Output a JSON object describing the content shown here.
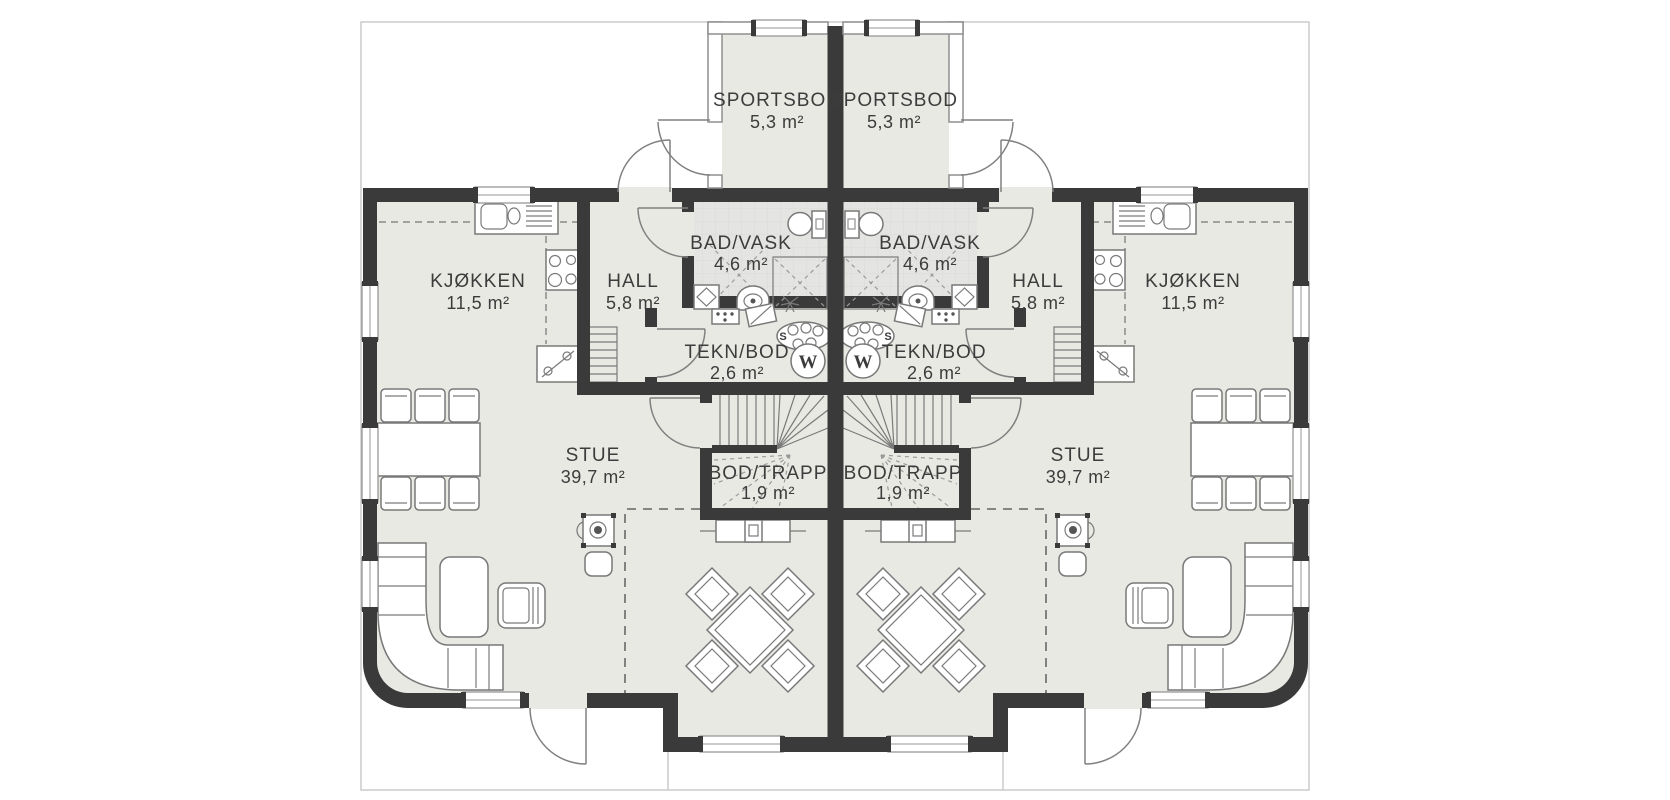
{
  "rooms": {
    "sportsbod": {
      "name": "SPORTSBOD",
      "area": "5,3 m²"
    },
    "bad_vask": {
      "name": "BAD/VASK",
      "area": "4,6 m²"
    },
    "hall": {
      "name": "HALL",
      "area": "5,8 m²"
    },
    "kjokken": {
      "name": "KJØKKEN",
      "area": "11,5 m²"
    },
    "tekn_bod": {
      "name": "TEKN/BOD",
      "area": "2,6 m²"
    },
    "bod_trapp": {
      "name": "BOD/TRAPP",
      "area": "1,9 m²"
    },
    "stue": {
      "name": "STUE",
      "area": "39,7 m²"
    }
  },
  "symbols": {
    "water_heater_label": "W",
    "distributor_label": "S"
  },
  "colors": {
    "wall": "#3a3a3a",
    "floor": "#e9e9e4",
    "wet_floor": "#e4e4e2",
    "boundary": "#c2c2c2",
    "line": "#7a7a7a",
    "background": "#ffffff"
  }
}
